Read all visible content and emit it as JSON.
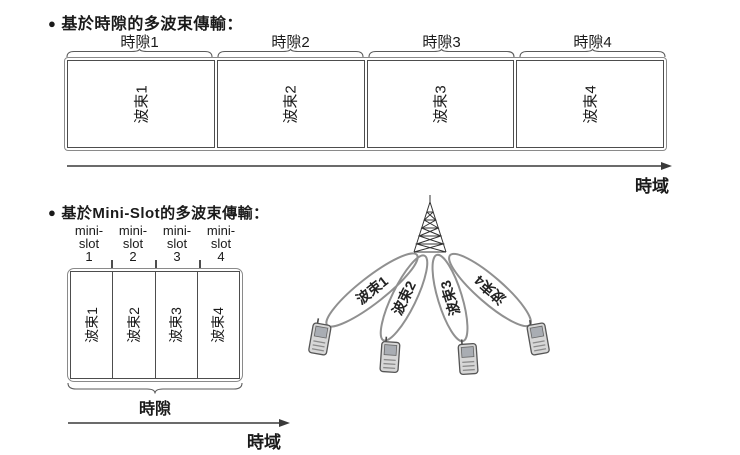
{
  "slot_section": {
    "bullet": "●",
    "title": "基於時隙的多波束傳輸：",
    "slot_labels": [
      "時隙1",
      "時隙2",
      "時隙3",
      "時隙4"
    ],
    "beam_labels": [
      "波束1",
      "波束2",
      "波束3",
      "波束4"
    ],
    "time_axis_label": "時域"
  },
  "minislot_section": {
    "bullet": "●",
    "title": "基於Mini-Slot的多波束傳輸：",
    "columns": [
      {
        "line1": "mini-",
        "line2": "slot",
        "line3": "1"
      },
      {
        "line1": "mini-",
        "line2": "slot",
        "line3": "2"
      },
      {
        "line1": "mini-",
        "line2": "slot",
        "line3": "3"
      },
      {
        "line1": "mini-",
        "line2": "slot",
        "line3": "4"
      }
    ],
    "beam_labels": [
      "波束1",
      "波束2",
      "波束3",
      "波束4"
    ],
    "brace_label": "時隙",
    "time_axis_label": "時域"
  },
  "illustration": {
    "beam_labels": [
      "波束1",
      "波束2",
      "波束3",
      "波束4"
    ]
  },
  "colors": {
    "ink": "#1a1a1a",
    "box_border": "#4d4d4d",
    "beam_stroke": "#909090",
    "arrow": "#3a3a3a",
    "phone_body": "#d7d7d7",
    "phone_screen": "#a9adb3"
  }
}
